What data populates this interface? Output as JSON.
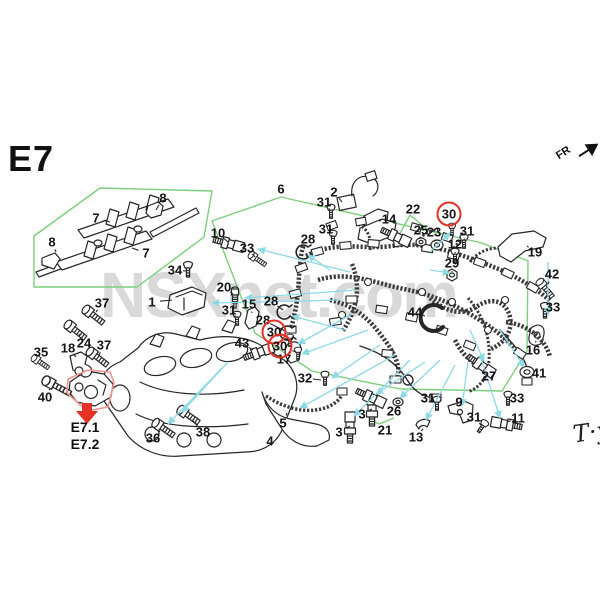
{
  "page": {
    "code": "E7",
    "fr": "FR",
    "ref1": "E7.1",
    "ref2": "E7.2",
    "signature": "T·y",
    "watermark": "NSXnet.com"
  },
  "colors": {
    "group_box_green": "#7ccf7c",
    "leader_cyan": "#8ed9e6",
    "highlight_red": "#e53226",
    "soft_red_box": "#f19490",
    "line_black": "#262626",
    "watermark_gray": "#d9d9d9"
  },
  "labels": [
    {
      "n": "1",
      "x": 152,
      "y": 302,
      "l": [
        172,
        300
      ]
    },
    {
      "n": "2",
      "x": 334,
      "y": 192,
      "l": [
        342,
        202
      ]
    },
    {
      "n": "3",
      "x": 362,
      "y": 414,
      "l": [
        372,
        409
      ]
    },
    {
      "n": "3",
      "x": 339,
      "y": 432,
      "l": [
        350,
        426
      ]
    },
    {
      "n": "4",
      "x": 270,
      "y": 441
    },
    {
      "n": "5",
      "x": 283,
      "y": 423,
      "l": [
        287,
        413
      ]
    },
    {
      "n": "6",
      "x": 281,
      "y": 189
    },
    {
      "n": "7",
      "x": 96,
      "y": 218,
      "l": [
        110,
        222
      ]
    },
    {
      "n": "7",
      "x": 146,
      "y": 253,
      "l": [
        132,
        248
      ]
    },
    {
      "n": "8",
      "x": 163,
      "y": 198,
      "l": [
        156,
        210
      ]
    },
    {
      "n": "8",
      "x": 52,
      "y": 242,
      "l": [
        56,
        252
      ]
    },
    {
      "n": "9",
      "x": 459,
      "y": 402,
      "l": [
        460,
        410
      ]
    },
    {
      "n": "10",
      "x": 218,
      "y": 233,
      "l": [
        228,
        242
      ]
    },
    {
      "n": "11",
      "x": 518,
      "y": 418,
      "l": [
        507,
        422
      ]
    },
    {
      "n": "12",
      "x": 455,
      "y": 244,
      "l": [
        455,
        253
      ]
    },
    {
      "n": "13",
      "x": 416,
      "y": 437,
      "l": [
        423,
        429
      ]
    },
    {
      "n": "14",
      "x": 389,
      "y": 219,
      "l": [
        379,
        221
      ]
    },
    {
      "n": "15",
      "x": 249,
      "y": 304,
      "l": [
        252,
        313
      ]
    },
    {
      "n": "16",
      "x": 533,
      "y": 350,
      "l": [
        536,
        341
      ]
    },
    {
      "n": "17",
      "x": 284,
      "y": 359,
      "l": [
        291,
        352
      ]
    },
    {
      "n": "18",
      "x": 68,
      "y": 348,
      "l": [
        76,
        357
      ]
    },
    {
      "n": "19",
      "x": 535,
      "y": 252,
      "l": [
        527,
        246
      ]
    },
    {
      "n": "20",
      "x": 224,
      "y": 287,
      "l": [
        233,
        294
      ]
    },
    {
      "n": "21",
      "x": 385,
      "y": 430
    },
    {
      "n": "22",
      "x": 413,
      "y": 209
    },
    {
      "n": "23",
      "x": 434,
      "y": 232,
      "l": [
        436,
        241
      ]
    },
    {
      "n": "24",
      "x": 84,
      "y": 343,
      "l": [
        79,
        334
      ]
    },
    {
      "n": "25",
      "x": 421,
      "y": 230,
      "l": [
        421,
        238
      ]
    },
    {
      "n": "26",
      "x": 394,
      "y": 411,
      "l": [
        397,
        404
      ]
    },
    {
      "n": "27",
      "x": 489,
      "y": 376,
      "l": [
        484,
        369
      ]
    },
    {
      "n": "28",
      "x": 308,
      "y": 239,
      "l": [
        304,
        249
      ]
    },
    {
      "n": "28",
      "x": 271,
      "y": 301,
      "l": [
        283,
        310
      ]
    },
    {
      "n": "28",
      "x": 263,
      "y": 320,
      "l": [
        285,
        331
      ]
    },
    {
      "n": "29",
      "x": 452,
      "y": 263,
      "l": [
        452,
        272
      ]
    },
    {
      "n": "30",
      "x": 449,
      "y": 214,
      "c": 1,
      "l": [
        452,
        227
      ]
    },
    {
      "n": "30",
      "x": 274,
      "y": 332,
      "c": 1,
      "l": [
        288,
        340
      ]
    },
    {
      "n": "30",
      "x": 280,
      "y": 346,
      "c": 1,
      "l": [
        296,
        352
      ]
    },
    {
      "n": "31",
      "x": 324,
      "y": 202,
      "l": [
        330,
        210
      ]
    },
    {
      "n": "31",
      "x": 326,
      "y": 229,
      "l": [
        332,
        236
      ]
    },
    {
      "n": "31",
      "x": 467,
      "y": 231,
      "l": [
        464,
        240
      ]
    },
    {
      "n": "31",
      "x": 229,
      "y": 310,
      "l": [
        236,
        317
      ]
    },
    {
      "n": "31",
      "x": 428,
      "y": 398,
      "l": [
        436,
        403
      ]
    },
    {
      "n": "31",
      "x": 474,
      "y": 417,
      "l": [
        481,
        425
      ]
    },
    {
      "n": "32",
      "x": 305,
      "y": 378,
      "l": [
        321,
        380
      ]
    },
    {
      "n": "33",
      "x": 247,
      "y": 248,
      "l": [
        255,
        257
      ]
    },
    {
      "n": "33",
      "x": 553,
      "y": 307,
      "l": [
        546,
        310
      ]
    },
    {
      "n": "33",
      "x": 517,
      "y": 398,
      "l": [
        509,
        398
      ]
    },
    {
      "n": "34",
      "x": 175,
      "y": 270,
      "l": [
        186,
        271
      ]
    },
    {
      "n": "35",
      "x": 41,
      "y": 352,
      "l": [
        42,
        361
      ]
    },
    {
      "n": "36",
      "x": 153,
      "y": 438,
      "l": [
        160,
        431
      ]
    },
    {
      "n": "37",
      "x": 102,
      "y": 303,
      "l": [
        96,
        312
      ]
    },
    {
      "n": "37",
      "x": 104,
      "y": 345,
      "l": [
        99,
        355
      ]
    },
    {
      "n": "38",
      "x": 203,
      "y": 432,
      "l": [
        193,
        421
      ]
    },
    {
      "n": "40",
      "x": 45,
      "y": 397,
      "l": [
        50,
        389
      ]
    },
    {
      "n": "41",
      "x": 539,
      "y": 373,
      "l": [
        531,
        372
      ]
    },
    {
      "n": "42",
      "x": 552,
      "y": 274,
      "l": [
        548,
        284
      ]
    },
    {
      "n": "43",
      "x": 242,
      "y": 343,
      "l": [
        253,
        350
      ]
    },
    {
      "n": "44",
      "x": 415,
      "y": 312,
      "l": [
        425,
        316
      ]
    }
  ]
}
